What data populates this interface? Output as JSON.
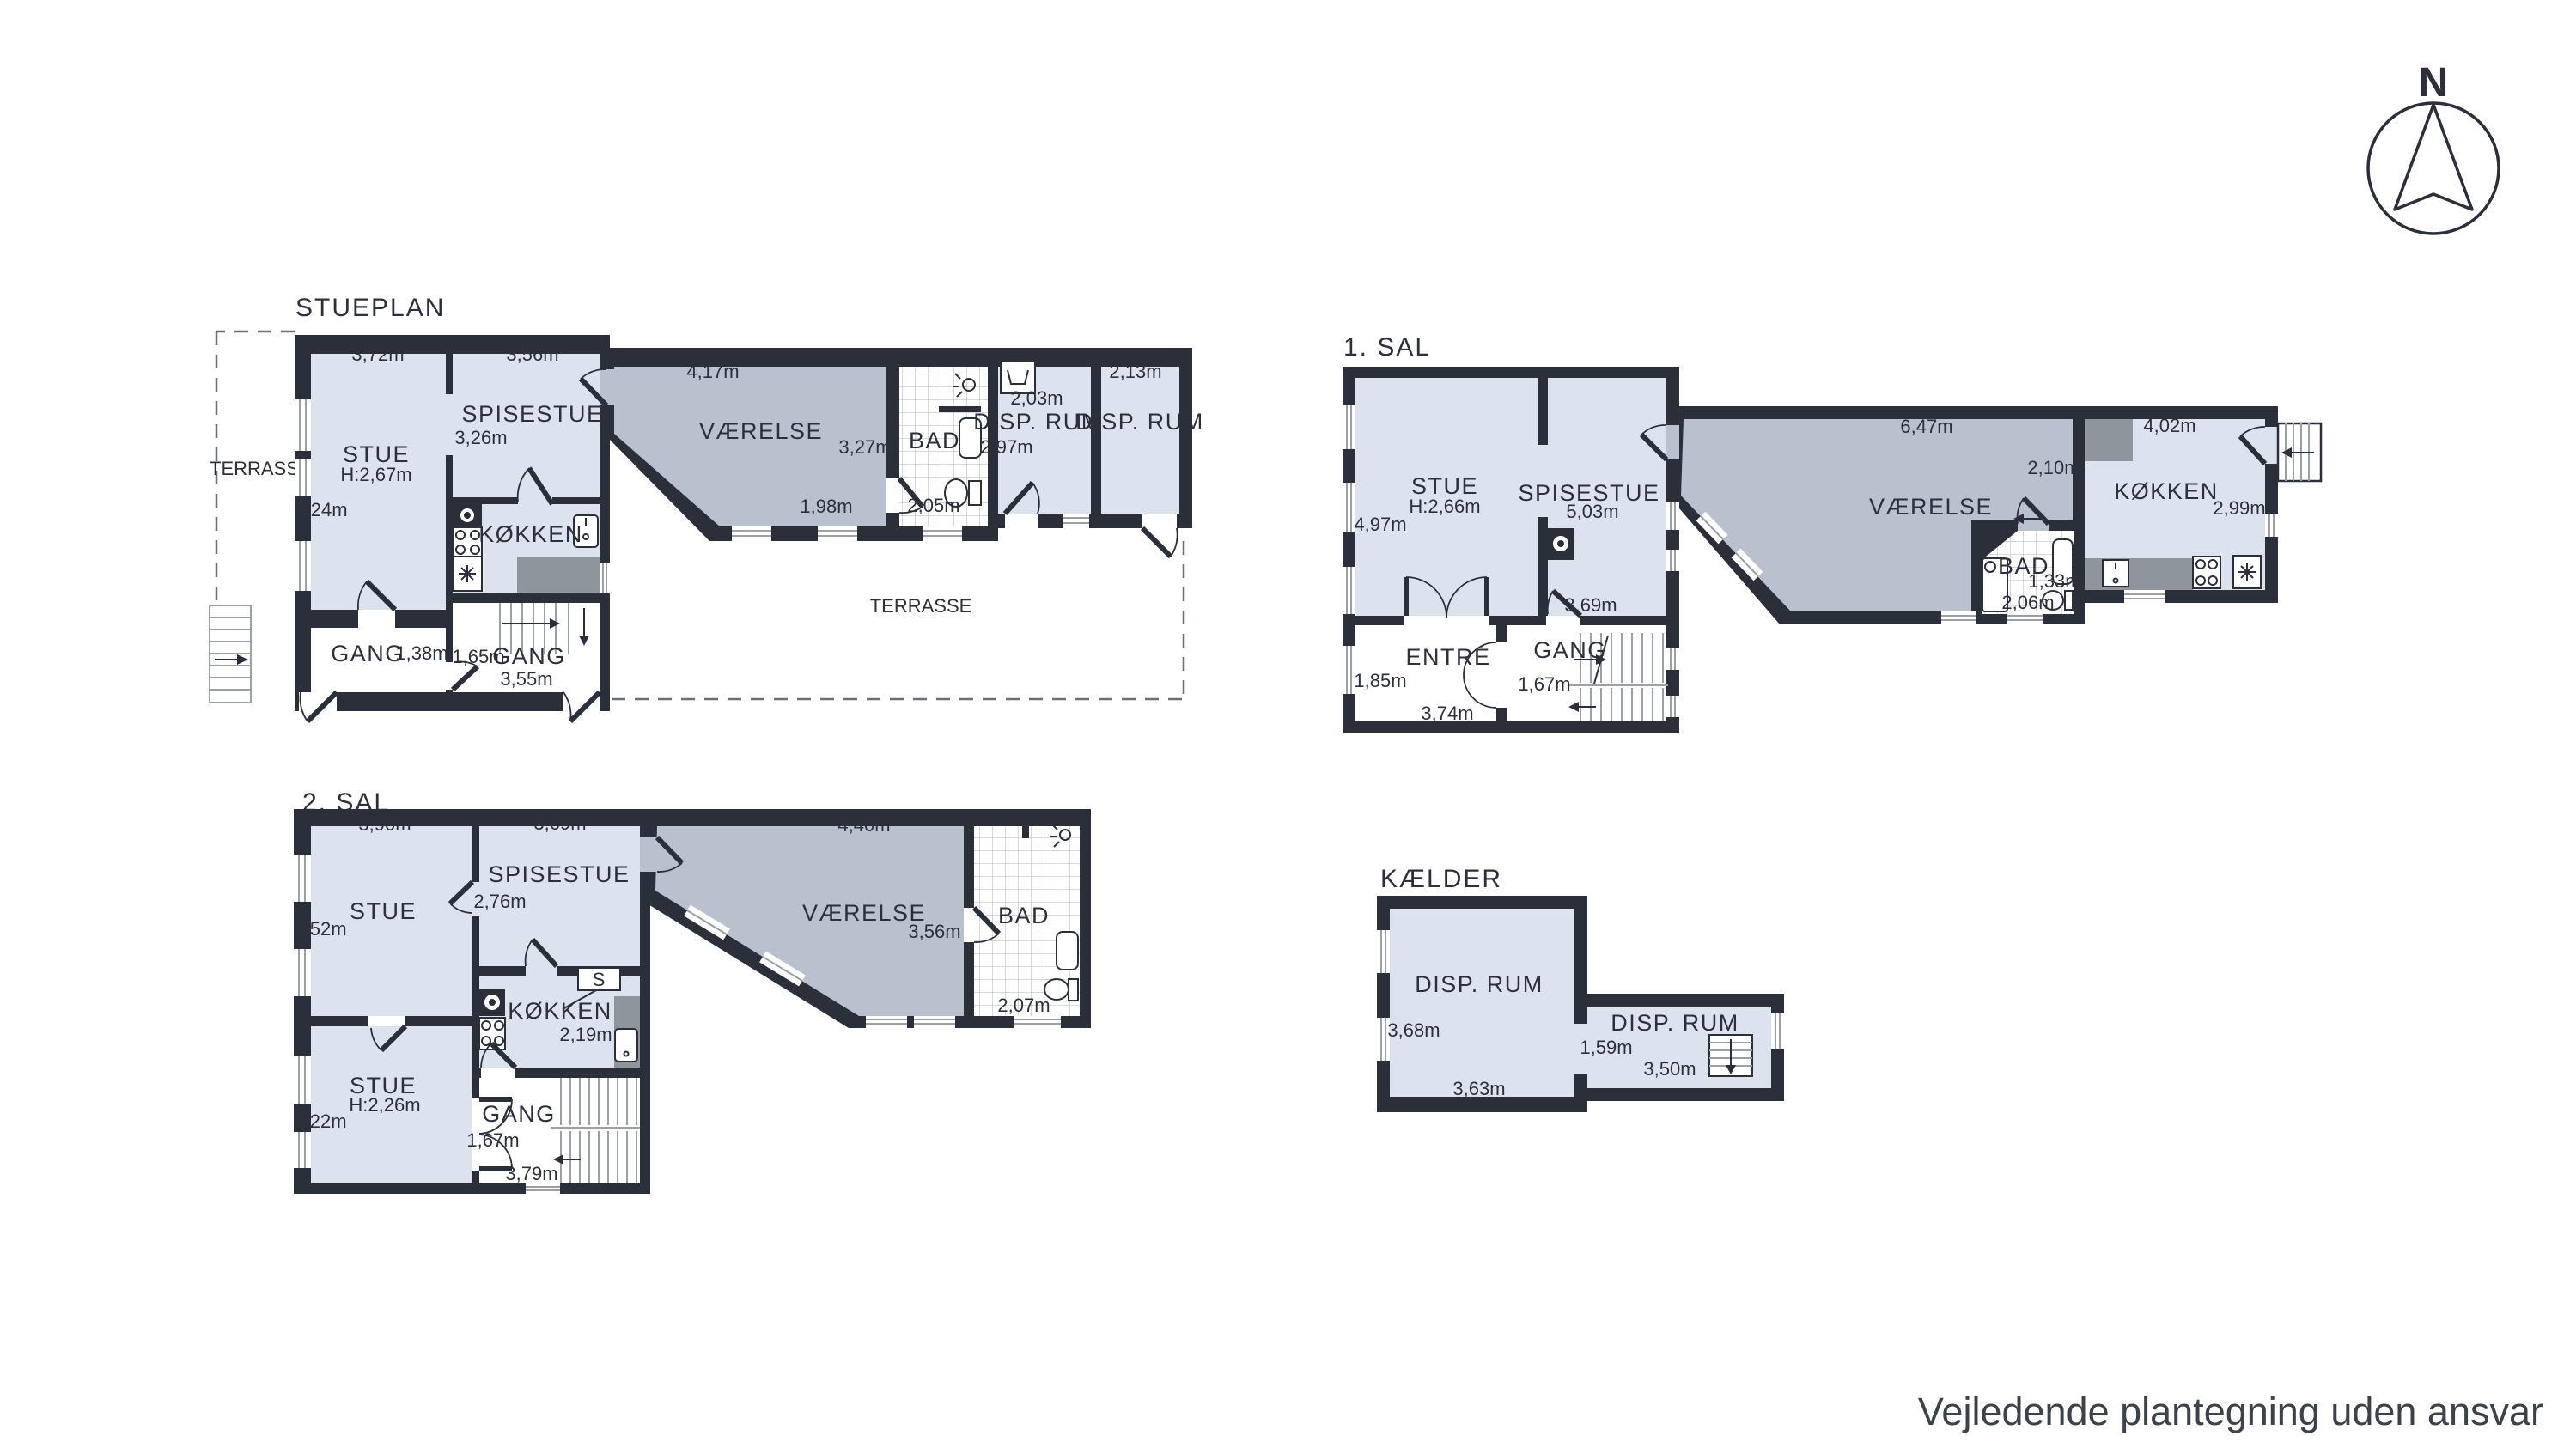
{
  "page": {
    "compass": "N",
    "footer": "Vejledende plantegning uden ansvar"
  },
  "stueplan": {
    "title": "STUEPLAN",
    "terrasse_left": "TERRASSE",
    "terrasse_bottom": "TERRASSE",
    "stue": {
      "name": "STUE",
      "h": "H:2,67m",
      "w": "3,72m",
      "d": "5,24m"
    },
    "spisestue": {
      "name": "SPISESTUE",
      "w": "3,56m",
      "d": "3,26m"
    },
    "koekken": {
      "name": "KØKKEN"
    },
    "gang1": {
      "name": "GANG",
      "w": "1,38m"
    },
    "gang2": {
      "name": "GANG",
      "w2": "1,65m",
      "w": "3,55m"
    },
    "vaerelse": {
      "name": "VÆRELSE",
      "w": "4,17m",
      "d": "3,27m",
      "w2": "1,98m"
    },
    "bad": {
      "name": "BAD",
      "w": "2,05m"
    },
    "disp1": {
      "name": "DISP. RUM",
      "w": "2,03m",
      "d": "2,97m"
    },
    "disp2": {
      "name": "DISP. RUM",
      "w": "2,13m"
    }
  },
  "sal1": {
    "title": "1. SAL",
    "stue": {
      "name": "STUE",
      "h": "H:2,66m",
      "d": "4,97m"
    },
    "spisestue": {
      "name": "SPISESTUE",
      "w": "5,03m",
      "d": "3,69m"
    },
    "entre": {
      "name": "ENTRÉ",
      "d": "1,85m",
      "w": "3,74m"
    },
    "gang": {
      "name": "GANG",
      "w": "1,67m"
    },
    "vaerelse": {
      "name": "VÆRELSE",
      "w": "6,47m",
      "d": "2,10m"
    },
    "bad": {
      "name": "BAD",
      "d": "1,33m",
      "w": "2,06m"
    },
    "koekken": {
      "name": "KØKKEN",
      "w": "4,02m",
      "d": "2,99m"
    }
  },
  "sal2": {
    "title": "2. SAL",
    "stue_top": {
      "name": "STUE",
      "w": "3,90m",
      "d": "3,52m"
    },
    "spisestue": {
      "name": "SPISESTUE",
      "w": "3,69m",
      "d": "2,76m"
    },
    "stue_bottom": {
      "name": "STUE",
      "h": "H:2,26m",
      "d": "3,22m"
    },
    "koekken": {
      "name": "KØKKEN",
      "d": "2,19m",
      "cabinet": "S"
    },
    "gang": {
      "name": "GANG",
      "w": "1,67m",
      "b": "3,79m"
    },
    "vaerelse": {
      "name": "VÆRELSE",
      "w": "4,40m",
      "d": "3,56m"
    },
    "bad": {
      "name": "BAD",
      "w": "2,07m"
    }
  },
  "kaelder": {
    "title": "KÆLDER",
    "disp1": {
      "name": "DISP. RUM",
      "d": "3,68m",
      "w": "3,63m"
    },
    "disp2": {
      "name": "DISP. RUM",
      "d": "1,59m",
      "w": "3,50m"
    }
  }
}
